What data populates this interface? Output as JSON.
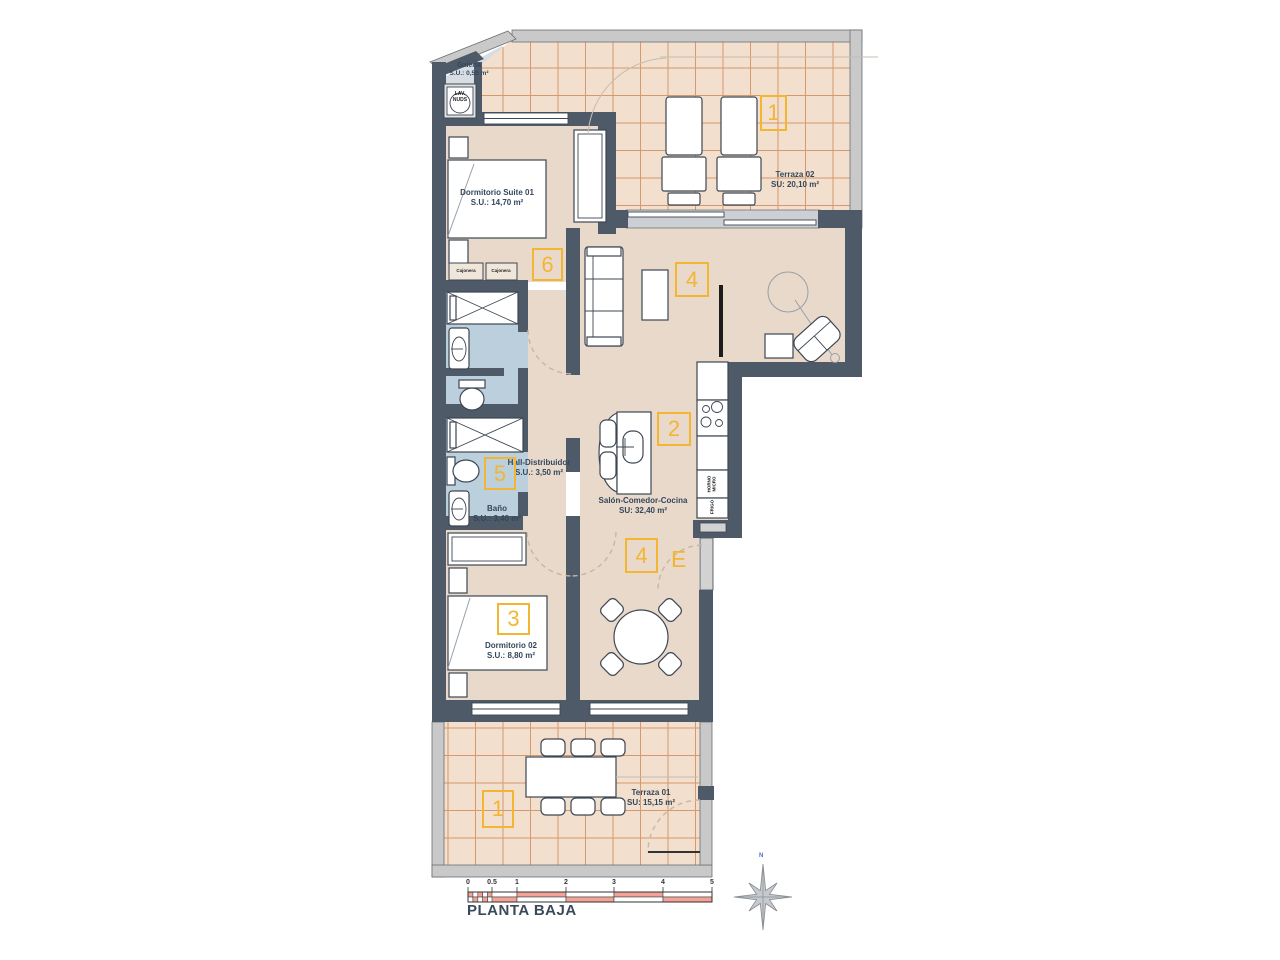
{
  "plan": {
    "title": "PLANTA BAJA",
    "compass_label": "N",
    "entrance_label": "E",
    "rooms": {
      "galeria": {
        "name": "Galería",
        "area": "S.U.: 0,50 m²"
      },
      "suite": {
        "name": "Dormitorio Suite 01",
        "area": "S.U.: 14,70 m²"
      },
      "terraza02": {
        "name": "Terraza 02",
        "area": "SU: 20,10 m²"
      },
      "hall": {
        "name": "Hall-Distribuidor",
        "area": "S.U.: 3,50 m²"
      },
      "bano": {
        "name": "Baño",
        "area": "S.U.: 3,40 m²"
      },
      "salon": {
        "name": "Salón-Comedor-Cocina",
        "area": "SU: 32,40 m²"
      },
      "dorm02": {
        "name": "Dormitorio 02",
        "area": "S.U.: 8,80 m²"
      },
      "terraza01": {
        "name": "Terraza 01",
        "area": "SU: 15,15 m²"
      }
    },
    "markers": {
      "terraza02": "1",
      "suite": "6",
      "salon": "4",
      "cocina": "2",
      "bano": "5",
      "entrada": "4",
      "dorm02": "3",
      "terraza01": "1"
    },
    "fixtures": {
      "cajonera_left": "Cajonera",
      "cajonera_right": "Cajonera",
      "lav_line1": "LAV.",
      "lav_line2": "NUDS",
      "horno_line1": "HORNO",
      "horno_line2": "MICRO",
      "frigo": "FRIGO"
    },
    "scale_ticks": [
      "0",
      "0.5",
      "1",
      "2",
      "3",
      "4",
      "5"
    ],
    "colors": {
      "wall": "#4f5a68",
      "outer_wall": "#c9c9c9",
      "tile": "#f2dfcd",
      "tile_grid": "#d49a6e",
      "floor": "#e9d9cb",
      "bath_floor": "#bccfdc",
      "accent": "#f2b632",
      "scale_pink": "#f2a296",
      "ink": "#33475c"
    }
  }
}
